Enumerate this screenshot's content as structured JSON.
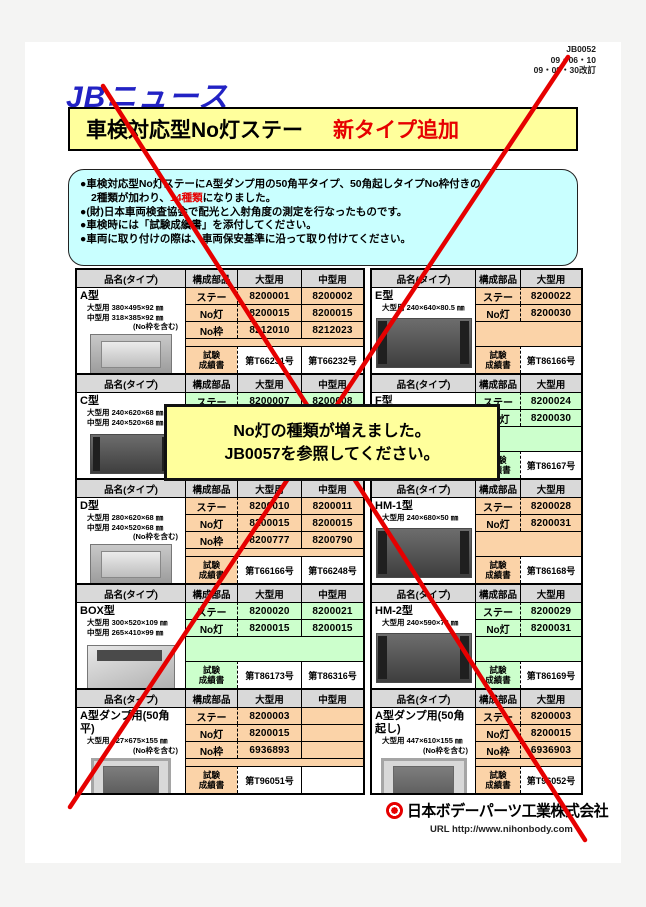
{
  "page": {
    "doc_number": "JB0052",
    "date_issued": "09・06・10",
    "date_revised": "09・09・30改訂",
    "logo": "JBニュース",
    "title": "車検対応型No灯ステー",
    "title_badge": "新タイプ追加"
  },
  "notice": {
    "bullet1_line1": "●車検対応型No灯ステーにA型ダンプ用の50角平タイプ、50角起しタイプNo枠付きの",
    "bullet1_line2a": "2種類が加わり、",
    "bullet1_line2_red": "14種類",
    "bullet1_line2b": "になりました。",
    "bullet2": "●(財)日本車両検査協会で配光と入射角度の測定を行なったものです。",
    "bullet3": "●車検時には「試験成績書」を添付してください。",
    "bullet4": "●車両に取り付けの際は、車両保安基準に沿って取り付けてください。"
  },
  "callout": {
    "line1": "No灯の種類が増えました。",
    "line2": "JB0057を参照してください。"
  },
  "table_headers": {
    "name": "品名(タイプ)",
    "component": "構成部品",
    "large": "大型用",
    "medium": "中型用"
  },
  "labels": {
    "cert_line1": "試験",
    "cert_line2": "成績書"
  },
  "tables_left": [
    {
      "id": "a",
      "name": "A型",
      "color": "peach",
      "photo": "tray",
      "dims": [
        "大型用  380×495×92 ㎜",
        "中型用  318×385×92 ㎜"
      ],
      "note": "(No枠を含む)",
      "rows": [
        {
          "label": "ステー",
          "large": "8200001",
          "medium": "8200002"
        },
        {
          "label": "No灯",
          "large": "8200015",
          "medium": "8200015"
        },
        {
          "label": "No枠",
          "large": "8212010",
          "medium": "8212023"
        }
      ],
      "cert": {
        "large": "第T66231号",
        "medium": "第T66232号"
      }
    },
    {
      "id": "c",
      "name": "C型",
      "color": "green",
      "photo": "bar",
      "dims": [
        "大型用  240×620×68 ㎜",
        "中型用  240×520×68 ㎜"
      ],
      "note": "",
      "rows": [
        {
          "label": "ステー",
          "large": "8200007",
          "medium": "8200008"
        },
        {
          "label": "",
          "large": "",
          "medium": ""
        }
      ],
      "cert": {
        "large": "",
        "medium": ""
      }
    },
    {
      "id": "d",
      "name": "D型",
      "color": "peach",
      "photo": "tray",
      "dims": [
        "大型用  280×620×68 ㎜",
        "中型用  240×520×68 ㎜"
      ],
      "note": "(No枠を含む)",
      "rows": [
        {
          "label": "ステー",
          "large": "8200010",
          "medium": "8200011"
        },
        {
          "label": "No灯",
          "large": "8200015",
          "medium": "8200015"
        },
        {
          "label": "No枠",
          "large": "8200777",
          "medium": "8200790"
        }
      ],
      "cert": {
        "large": "第T66166号",
        "medium": "第T66248号"
      }
    },
    {
      "id": "box",
      "name": "BOX型",
      "color": "green",
      "photo": "box",
      "dims": [
        "大型用  300×520×109 ㎜",
        "中型用  265×410×99 ㎜"
      ],
      "note": "",
      "rows": [
        {
          "label": "ステー",
          "large": "8200020",
          "medium": "8200021"
        },
        {
          "label": "No灯",
          "large": "8200015",
          "medium": "8200015"
        }
      ],
      "cert": {
        "large": "第T86173号",
        "medium": "第T86316号"
      }
    },
    {
      "id": "dump-flat",
      "name": "A型ダンプ用(50角平)",
      "color": "peach",
      "photo": "frame",
      "dims": [
        "大型用  427×675×155 ㎜"
      ],
      "note": "(No枠を含む)",
      "rows": [
        {
          "label": "ステー",
          "large": "8200003"
        },
        {
          "label": "No灯",
          "large": "8200015"
        },
        {
          "label": "No枠",
          "large": "6936893"
        }
      ],
      "cert": {
        "large": "第T96051号"
      }
    }
  ],
  "tables_right": [
    {
      "id": "e",
      "name": "E型",
      "color": "peach",
      "photo": "bar",
      "dims": [
        "大型用  240×640×80.5 ㎜"
      ],
      "note": "",
      "rows": [
        {
          "label": "ステー",
          "large": "8200022"
        },
        {
          "label": "No灯",
          "large": "8200030"
        }
      ],
      "cert": {
        "large": "第T86166号"
      }
    },
    {
      "id": "f",
      "name": "F型",
      "color": "green",
      "photo": "bar",
      "dims": [],
      "note": "",
      "rows": [
        {
          "label": "ステー",
          "large": "8200024"
        },
        {
          "label": "No灯",
          "large": "8200030"
        }
      ],
      "cert": {
        "large": "第T86167号"
      }
    },
    {
      "id": "hm1",
      "name": "HM-1型",
      "color": "peach",
      "photo": "bar",
      "dims": [
        "大型用  240×680×50 ㎜"
      ],
      "note": "",
      "rows": [
        {
          "label": "ステー",
          "large": "8200028"
        },
        {
          "label": "No灯",
          "large": "8200031"
        }
      ],
      "cert": {
        "large": "第T86168号"
      }
    },
    {
      "id": "hm2",
      "name": "HM-2型",
      "color": "green",
      "photo": "bar",
      "dims": [
        "大型用  240×590×78 ㎜"
      ],
      "note": "",
      "rows": [
        {
          "label": "ステー",
          "large": "8200029"
        },
        {
          "label": "No灯",
          "large": "8200031"
        }
      ],
      "cert": {
        "large": "第T86169号"
      }
    },
    {
      "id": "dump-raised",
      "name": "A型ダンプ用(50角起し)",
      "color": "peach",
      "photo": "frame",
      "dims": [
        "大型用  447×610×155 ㎜"
      ],
      "note": "(No枠を含む)",
      "rows": [
        {
          "label": "ステー",
          "large": "8200003"
        },
        {
          "label": "No灯",
          "large": "8200015"
        },
        {
          "label": "No枠",
          "large": "6936903"
        }
      ],
      "cert": {
        "large": "第T96052号"
      }
    }
  ],
  "footer": {
    "company": "日本ボデーパーツ工業株式会社",
    "url": "URL http://www.nihonbody.com",
    "accent_color": "#e60000"
  }
}
